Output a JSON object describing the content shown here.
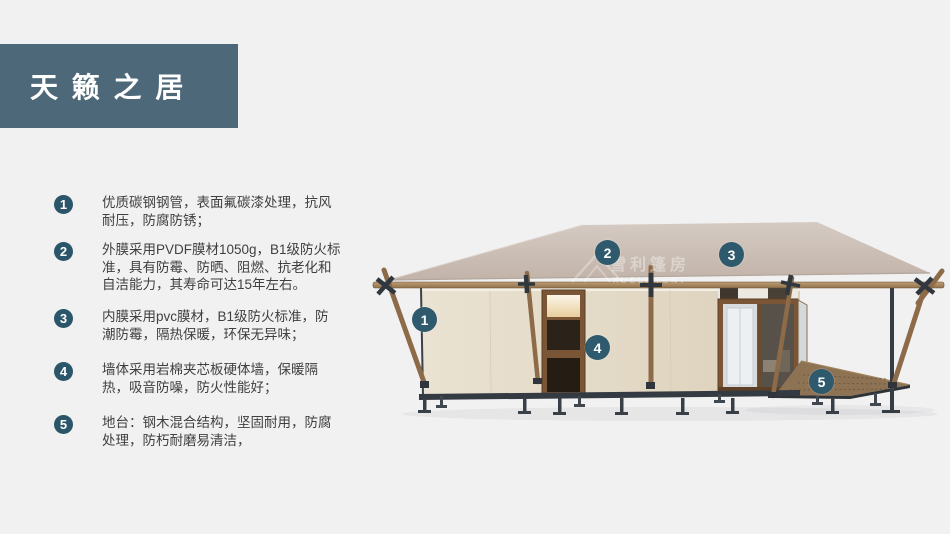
{
  "slide": {
    "title": "天 籁 之 居",
    "features": [
      {
        "num": "1",
        "text": "优质碳钢钢管，表面氟碳漆处理，抗风耐压，防腐防锈；"
      },
      {
        "num": "2",
        "text": "外膜采用PVDF膜材1050g，B1级防火标准，具有防霉、防晒、阻燃、抗老化和自洁能力，其寿命可达15年左右。"
      },
      {
        "num": "3",
        "text": "内膜采用pvc膜材，B1级防火标准，防潮防霉，隔热保暖，环保无异味；"
      },
      {
        "num": "4",
        "text": "墙体采用岩棉夹芯板硬体墙，保暖隔热，吸音防噪，防火性能好；"
      },
      {
        "num": "5",
        "text": "地台：钢木混合结构，坚固耐用，防腐处理，防朽耐磨易清洁，"
      }
    ],
    "callouts": [
      {
        "num": "1"
      },
      {
        "num": "2"
      },
      {
        "num": "3"
      },
      {
        "num": "4"
      },
      {
        "num": "5"
      }
    ],
    "watermark": {
      "cn": "雪利篷房",
      "en": "XUELI TENT"
    },
    "colors": {
      "banner": "#4d6879",
      "badge": "#2b5568",
      "callout": "#2f5a6e",
      "roof": "#cbbeb4",
      "wall": "#e5dcca",
      "wood": "#8d6b49",
      "steel": "#363c43"
    }
  }
}
